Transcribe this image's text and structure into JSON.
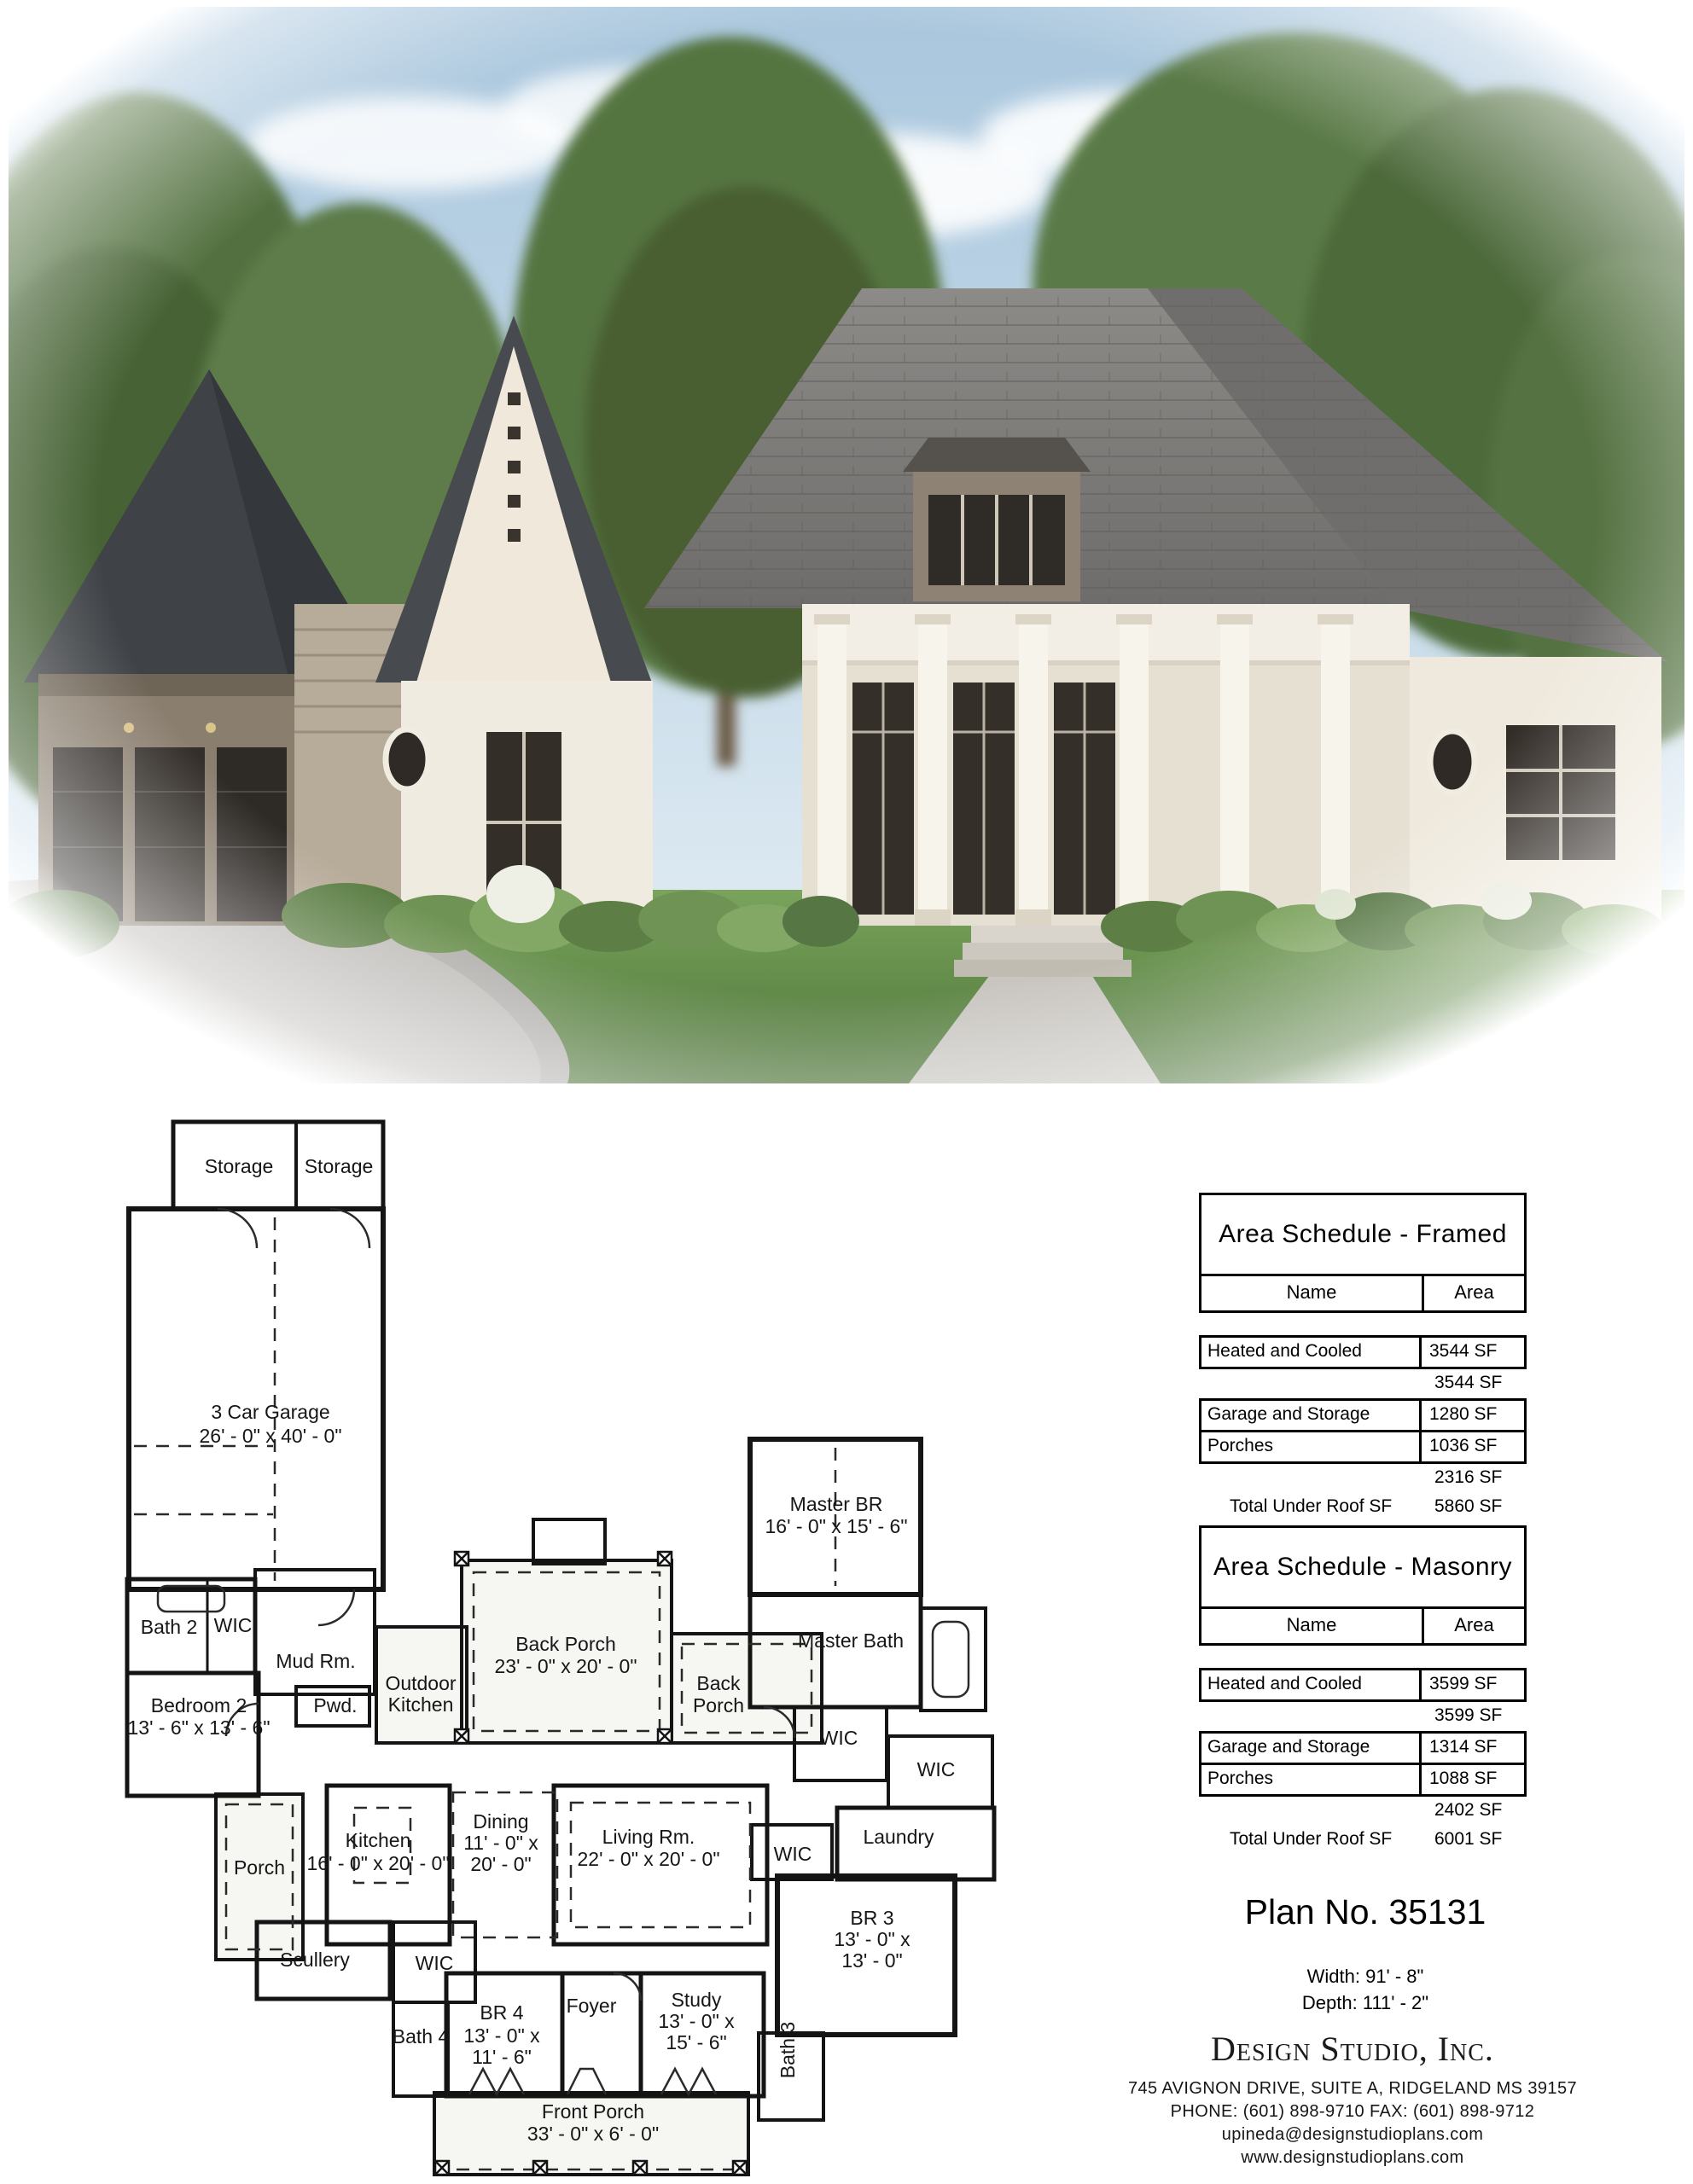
{
  "rendering": {
    "description": "Front exterior rendering of a French country style house with white brick, taupe garage wing, dark shingle roofs, columned front porch and landscaped lawn",
    "colors": {
      "sky_top": "#a9c6dd",
      "sky_bottom": "#e9f1f6",
      "tree_green": "#55743f",
      "roof_dark": "#3f4246",
      "roof_main": "#7b7977",
      "wall_cream": "#f0ebe0",
      "siding_taupe": "#8a7e6f",
      "window_dark": "#322c27",
      "lawn_green": "#639048",
      "driveway_gray": "#b2b0ad"
    }
  },
  "floor_plan": {
    "rooms": {
      "storage_left": {
        "label": "Storage"
      },
      "storage_right": {
        "label": "Storage"
      },
      "garage": {
        "label": "3 Car Garage",
        "dims": "26' - 0\" x 40' - 0\""
      },
      "bath2": {
        "label": "Bath 2"
      },
      "wic_bath2": {
        "label": "WIC"
      },
      "mud": {
        "label": "Mud Rm."
      },
      "bedroom2": {
        "label": "Bedroom 2",
        "dims": "13' - 6\" x 13' - 6\""
      },
      "pwd": {
        "label": "Pwd."
      },
      "outdoor_kitchen": {
        "label": "Outdoor",
        "label2": "Kitchen"
      },
      "back_porch": {
        "label": "Back Porch",
        "dims": "23' - 0\" x 20' - 0\""
      },
      "back_porch_right": {
        "label": "Back",
        "label2": "Porch"
      },
      "master_br": {
        "label": "Master BR",
        "dims": "16' - 0\" x 15' - 6\""
      },
      "master_bath": {
        "label": "Master Bath"
      },
      "wic_master": {
        "label": "WIC"
      },
      "wic_right": {
        "label": "WIC"
      },
      "laundry": {
        "label": "Laundry"
      },
      "wic_hall": {
        "label": "WIC"
      },
      "porch_left": {
        "label": "Porch"
      },
      "kitchen": {
        "label": "Kitchen",
        "dims": "16' - 0\" x 20' - 0\""
      },
      "dining": {
        "label": "Dining",
        "dims": "11' - 0\" x",
        "dims2": "20' - 0\""
      },
      "living": {
        "label": "Living Rm.",
        "dims": "22' - 0\" x 20' - 0\""
      },
      "br3": {
        "label": "BR 3",
        "dims": "13' - 0\" x",
        "dims2": "13' - 0\""
      },
      "scullery": {
        "label": "Scullery"
      },
      "wic_br4": {
        "label": "WIC"
      },
      "br4": {
        "label": "BR  4",
        "dims": "13' - 0\" x",
        "dims2": "11' - 6\""
      },
      "foyer": {
        "label": "Foyer"
      },
      "study": {
        "label": "Study",
        "dims": "13' - 0\" x",
        "dims2": "15' - 6\""
      },
      "bath4": {
        "label": "Bath 4"
      },
      "bath3": {
        "label": "Bath 3"
      },
      "front_porch": {
        "label": "Front Porch",
        "dims": "33' - 0\" x 6' - 0\""
      }
    }
  },
  "area_schedules": [
    {
      "title": "Area Schedule - Framed",
      "col_name": "Name",
      "col_area": "Area",
      "rows": [
        {
          "name": "Heated and Cooled",
          "area": "3544 SF"
        },
        {
          "name": "",
          "area": "3544 SF"
        },
        {
          "name": "Garage and Storage",
          "area": "1280 SF"
        },
        {
          "name": "Porches",
          "area": "1036 SF"
        },
        {
          "name": "",
          "area": "2316 SF"
        },
        {
          "name": "Total Under Roof SF",
          "area": "5860 SF"
        }
      ]
    },
    {
      "title": "Area Schedule - Masonry",
      "col_name": "Name",
      "col_area": "Area",
      "rows": [
        {
          "name": "Heated and Cooled",
          "area": "3599 SF"
        },
        {
          "name": "",
          "area": "3599 SF"
        },
        {
          "name": "Garage and Storage",
          "area": "1314 SF"
        },
        {
          "name": "Porches",
          "area": "1088 SF"
        },
        {
          "name": "",
          "area": "2402 SF"
        },
        {
          "name": "Total Under Roof SF",
          "area": "6001 SF"
        }
      ]
    }
  ],
  "plan_info": {
    "plan_no": "Plan No. 35131",
    "width": "Width: 91' - 8\"",
    "depth": "Depth: 111' - 2\""
  },
  "company": {
    "name": "Design Studio, Inc.",
    "address": "745 AVIGNON DRIVE, SUITE A, RIDGELAND MS 39157",
    "phone_fax": "PHONE: (601) 898-9710  FAX: (601) 898-9712",
    "email": "upineda@designstudioplans.com",
    "website": "www.designstudioplans.com"
  }
}
